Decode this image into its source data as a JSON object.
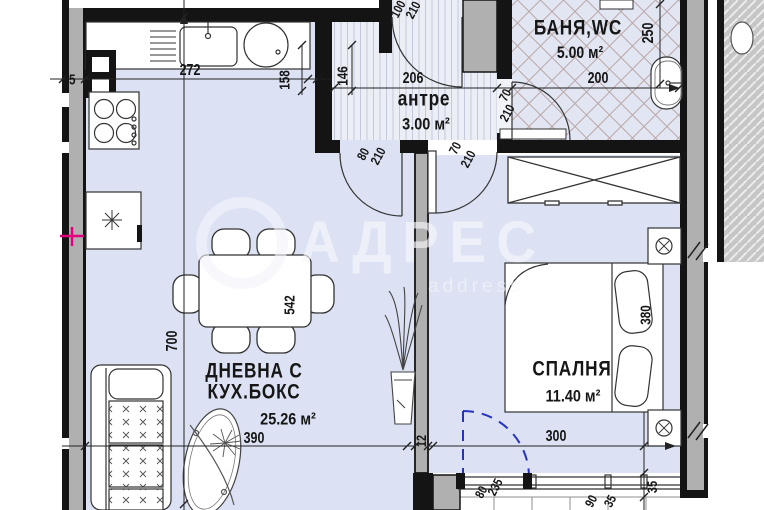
{
  "watermark": {
    "brand": "АДРЕС",
    "subtitle": "address."
  },
  "rooms": {
    "living": {
      "line1": "ДНЕВНА С",
      "line2": "КУХ.БОКС",
      "area": "25.26 м²"
    },
    "antre": {
      "name": "антре",
      "area": "3.00 м²"
    },
    "bath": {
      "name": "БАНЯ,WC",
      "area": "5.00 м²"
    },
    "bedroom": {
      "name": "СПАЛНЯ",
      "area": "11.40 м²"
    }
  },
  "dims": {
    "wall25": "25",
    "k272": "272",
    "k158": "158",
    "w12a": "12",
    "a146": "146",
    "a206": "206",
    "door100": "100",
    "door210a": "210",
    "b200": "200",
    "b250": "250",
    "bathdoor70": "70",
    "bathdoor210": "210",
    "beddoor70": "70",
    "beddoor210": "210",
    "livdoor80": "80",
    "livdoor210": "210",
    "t542": "542",
    "v700": "700",
    "l390": "390",
    "bed380": "380",
    "b300": "300",
    "w12b": "12",
    "bal80": "80",
    "bal235": "235",
    "w90": "90",
    "w35a": "35",
    "w35b": "35"
  },
  "colors": {
    "floor": "#dce2f3",
    "wall_gray": "#b0b0b0",
    "line": "#141414",
    "tile_line": "#bca8a8",
    "stripe_line": "#c3c9da",
    "balcony_door_blue": "#2633c0",
    "marker_magenta": "#e3007d"
  }
}
